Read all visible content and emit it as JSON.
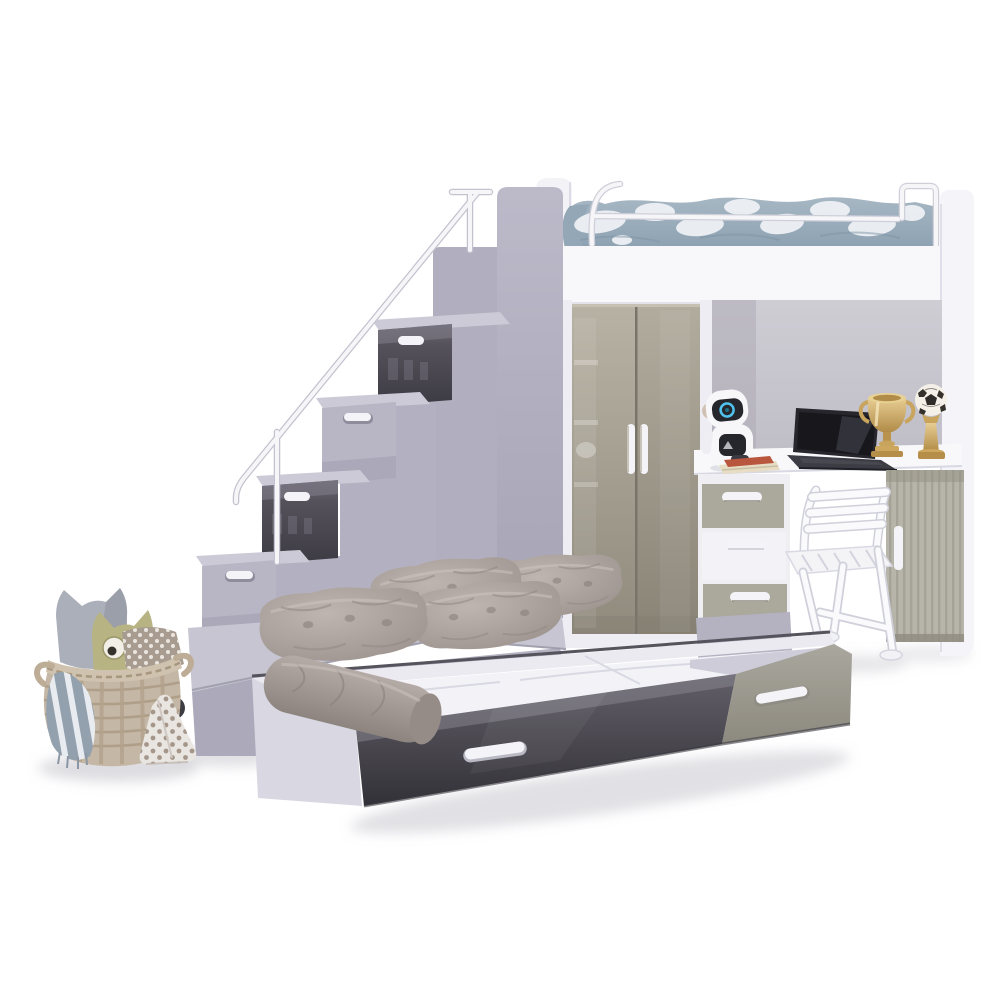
{
  "meta": {
    "kind": "product-photo",
    "subject": "Kids high-sleeper loft bed set with storage staircase, wardrobe, desk and pull-out trundle bed",
    "background": "#ffffff"
  },
  "palette": {
    "white_furniture": "#f8f8fb",
    "frame_white": "#eeedf3",
    "panel_white": "#f5f4f9",
    "headboard_grey": "#8e8e9a",
    "step_top": "#cbcad6",
    "step_front": "#b8b6c5",
    "lavender_column": "#b0aebf",
    "lavender_wall": "#b3b1c1",
    "platform_top": "#c6c5d1",
    "platform_side": "#aba9ba",
    "platform_band": "#b4b2c1",
    "gloss_dark_top": "#6e6b77",
    "gloss_dark_bottom": "#3c3a42",
    "door_greige_top": "#b8b2a4",
    "door_greige_bottom": "#8f897c",
    "drawer_greige": "#aba89c",
    "drawer_white": "#f3f3f7",
    "tambour": "#b7b5a9",
    "back_panel": "#c8c6cd",
    "handle_white": "#f4f4f8",
    "bedding_blue": "#9fb1c0",
    "bedding_white": "#eef1f5",
    "cushion_taupe": "#aca29e",
    "bolster_taupe": "#a89e99",
    "trundle_rim": "#eceaf1",
    "mattress_white": "#f2f2f7",
    "trundle_left": "#d8d7e2",
    "trundle_front_dark": "#47454e",
    "trundle_end_greige": "#a19e95",
    "basket_tan": "#c4b7a5",
    "basket_rim": "#cfc2ae",
    "owl_grey": "#aaafb9",
    "owl_olive": "#b7b383",
    "gold_mid": "#cda75e",
    "laptop_dark": "#26262c",
    "chair_white": "#f4f4f7",
    "robot_white": "#f7f6f8",
    "robot_screen": "#26262d",
    "caster_dark": "#3d3c43",
    "shadow_soft": "#a9a9b4"
  },
  "objects": {
    "bunk_bed": {
      "label": "upper loft bed with guard rail",
      "bedding": "blue-grey camouflage duvet"
    },
    "staircase": {
      "label": "storage step staircase with handrail",
      "steps": 4,
      "drawer_fronts": [
        "grey gloss",
        "lavender",
        "grey gloss",
        "lavender"
      ]
    },
    "wardrobe": {
      "label": "two-door gloss wardrobe",
      "doors": 2,
      "handle_style": "vertical white bars"
    },
    "desk": {
      "label": "integrated desk with three-drawer unit and shutter cabinet",
      "items": [
        "toy robot",
        "books",
        "laptop",
        "gold trophy cup",
        "football trophy"
      ]
    },
    "chair": {
      "label": "white folding chair"
    },
    "platform_bed": {
      "label": "lower bed platform with quilted cushions",
      "cushions": 4,
      "caster": "black wheel"
    },
    "trundle": {
      "label": "pull-out trundle drawer bed",
      "handles": 2,
      "extras": [
        "white mattress",
        "taupe bolster"
      ]
    },
    "basket_corner": {
      "label": "wicker basket with owl cushions",
      "items": [
        "grey owl cushion",
        "olive owl cushion",
        "striped blanket",
        "polka-dot cushion"
      ]
    }
  }
}
